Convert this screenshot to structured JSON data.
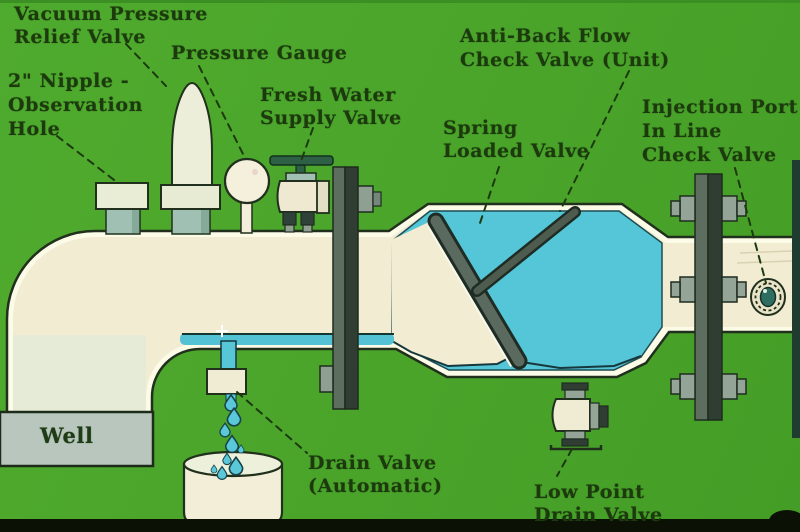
{
  "labels": {
    "vacuum_relief_valve": {
      "lines": [
        "Vacuum Pressure",
        "Relief Valve"
      ]
    },
    "pressure_gauge": {
      "lines": [
        "Pressure Gauge"
      ]
    },
    "nipple_observation": {
      "lines": [
        "2\" Nipple -",
        "Observation",
        "Hole"
      ]
    },
    "fresh_water_valve": {
      "lines": [
        "Fresh Water",
        "Supply Valve"
      ]
    },
    "anti_backflow_valve": {
      "lines": [
        "Anti-Back Flow",
        "Check Valve (Unit)"
      ]
    },
    "spring_loaded_valve": {
      "lines": [
        "Spring",
        "Loaded Valve"
      ]
    },
    "injection_port": {
      "lines": [
        "Injection Port -",
        "In Line",
        "Check Valve"
      ]
    },
    "well": {
      "lines": [
        "Well"
      ]
    },
    "drain_valve_auto": {
      "lines": [
        "Drain Valve",
        "(Automatic)"
      ]
    },
    "low_point_drain": {
      "lines": [
        "Low Point",
        "Drain Valve"
      ]
    }
  },
  "colors": {
    "background_green": "#4ba62b",
    "pipe_cream": "#f1ecd2",
    "pipe_highlight": "#fcfbe8",
    "water_blue": "#55c6d8",
    "metal_dark": "#2f3d33",
    "metal_light": "#94a496",
    "outline_dark": "#20301c",
    "label_text": "#1c3a0e",
    "well_gray": "#b9c6bd",
    "film_black": "#0c1106"
  }
}
